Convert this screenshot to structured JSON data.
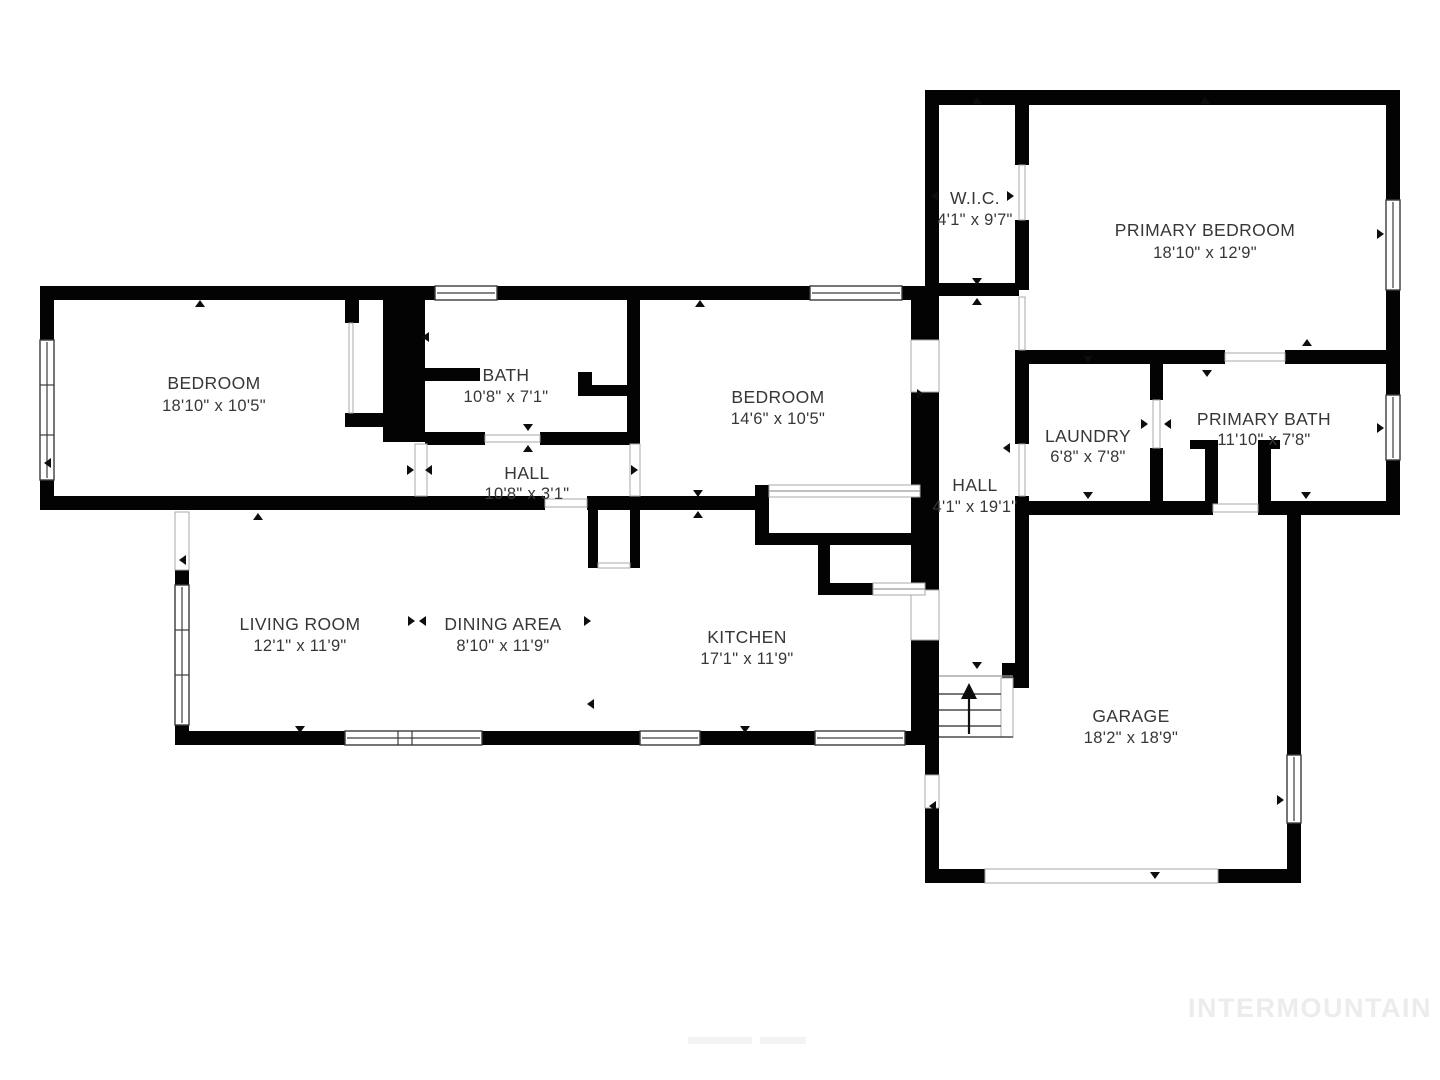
{
  "watermark": {
    "brand": "INTERMOUNTAIN"
  },
  "rooms": [
    {
      "id": "wic",
      "name": "W.I.C.",
      "dims": "4'1\" x 9'7\""
    },
    {
      "id": "primary-bedroom",
      "name": "PRIMARY BEDROOM",
      "dims": "18'10\" x 12'9\""
    },
    {
      "id": "bedroom-left",
      "name": "BEDROOM",
      "dims": "18'10\" x 10'5\""
    },
    {
      "id": "bath",
      "name": "BATH",
      "dims": "10'8\" x 7'1\""
    },
    {
      "id": "bedroom-middle",
      "name": "BEDROOM",
      "dims": "14'6\" x 10'5\""
    },
    {
      "id": "hall-bedroom-wing",
      "name": "HALL",
      "dims": "10'8\" x 3'1\""
    },
    {
      "id": "hall-main",
      "name": "HALL",
      "dims": "4'1\" x 19'1\""
    },
    {
      "id": "laundry",
      "name": "LAUNDRY",
      "dims": "6'8\" x 7'8\""
    },
    {
      "id": "primary-bath",
      "name": "PRIMARY BATH",
      "dims": "11'10\" x 7'8\""
    },
    {
      "id": "living-room",
      "name": "LIVING ROOM",
      "dims": "12'1\" x 11'9\""
    },
    {
      "id": "dining-area",
      "name": "DINING AREA",
      "dims": "8'10\" x 11'9\""
    },
    {
      "id": "kitchen",
      "name": "KITCHEN",
      "dims": "17'1\" x 11'9\""
    },
    {
      "id": "garage",
      "name": "GARAGE",
      "dims": "18'2\" x 18'9\""
    }
  ]
}
